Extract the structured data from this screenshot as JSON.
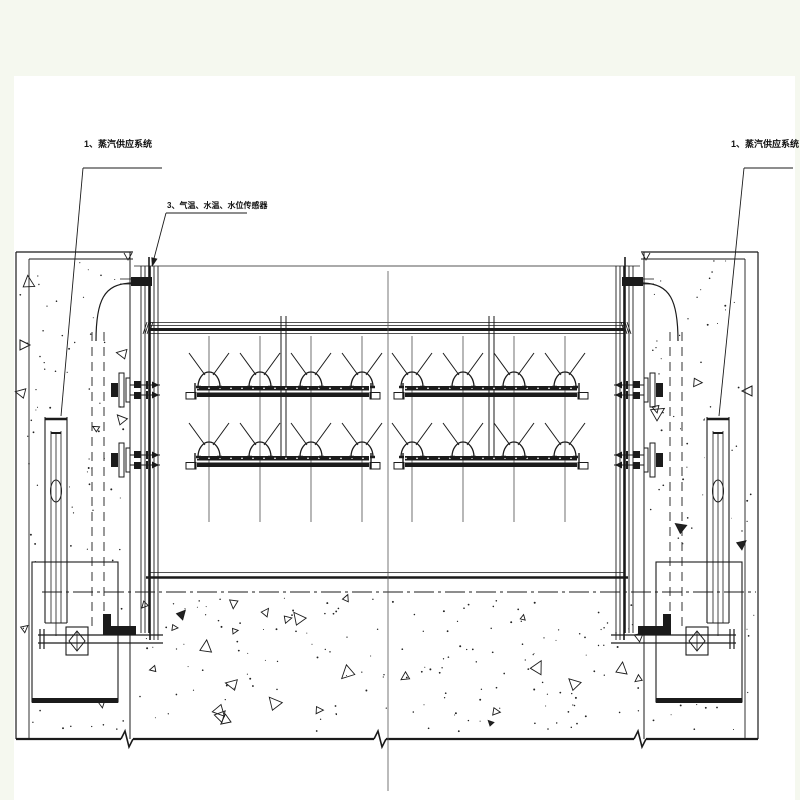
{
  "background": {
    "page_tint": "#f5f8ef",
    "paper": "#ffffff",
    "ink": "#1b1b1b",
    "centerline_color": "#555555"
  },
  "labels": {
    "steam_supply_left": "1、蒸汽供应系统",
    "sensors": "3、气温、水温、水位传感器",
    "steam_supply_right": "1、蒸汽供应系统"
  },
  "structure": {
    "aerator_rows": 2,
    "aerator_groups": 2,
    "nozzles_per_pipe": 4,
    "piers": 2,
    "valves": 2
  }
}
